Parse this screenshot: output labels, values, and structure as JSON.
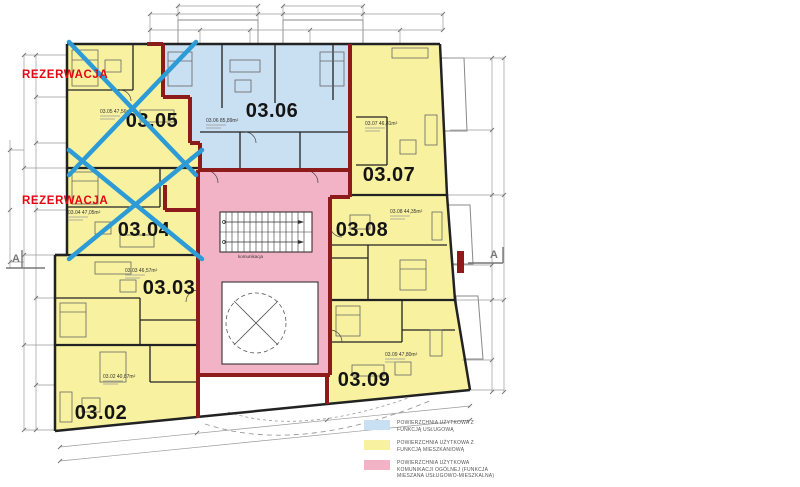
{
  "plan": {
    "reservation_label": "REZERWACJA",
    "section_marker": "A",
    "core_label": "komunikacja",
    "apartments": [
      {
        "number": "03.02",
        "area": "03.02  40,87m²"
      },
      {
        "number": "03.03",
        "area": "03.03  46,57m²"
      },
      {
        "number": "03.04",
        "area": "03.04  47,05m²"
      },
      {
        "number": "03.05",
        "area": "03.05  47,56m²"
      },
      {
        "number": "03.06",
        "area": "03.06  85,89m²"
      },
      {
        "number": "03.07",
        "area": "03.07  46,81m²"
      },
      {
        "number": "03.08",
        "area": "03.08  44,35m²"
      },
      {
        "number": "03.09",
        "area": "03.09  47,80m²"
      }
    ]
  },
  "colors": {
    "service_fill": "#c9dff2",
    "residential_fill": "#f8f2a0",
    "communication_fill": "#f2b3c6",
    "accent_wall": "#8e1b1b",
    "reservation_cross": "#2d9bd6",
    "reservation_text": "#e30613"
  },
  "legend": {
    "items": [
      {
        "key": "service",
        "label": "POWIERZCHNIA UŻYTKOWA Z\nFUNKCJĄ USŁUGOWĄ"
      },
      {
        "key": "residential",
        "label": "POWIERZCHNIA UŻYTKOWA Z\nFUNKCJĄ MIESZKANIOWĄ"
      },
      {
        "key": "communication",
        "label": "POWIERZCHNIA UŻYTKOWA\nKOMUNIKACJI OGÓLNEJ (FUNKCJA\nMIESZANA USŁUGOWO-MIESZKALNA)"
      }
    ]
  }
}
